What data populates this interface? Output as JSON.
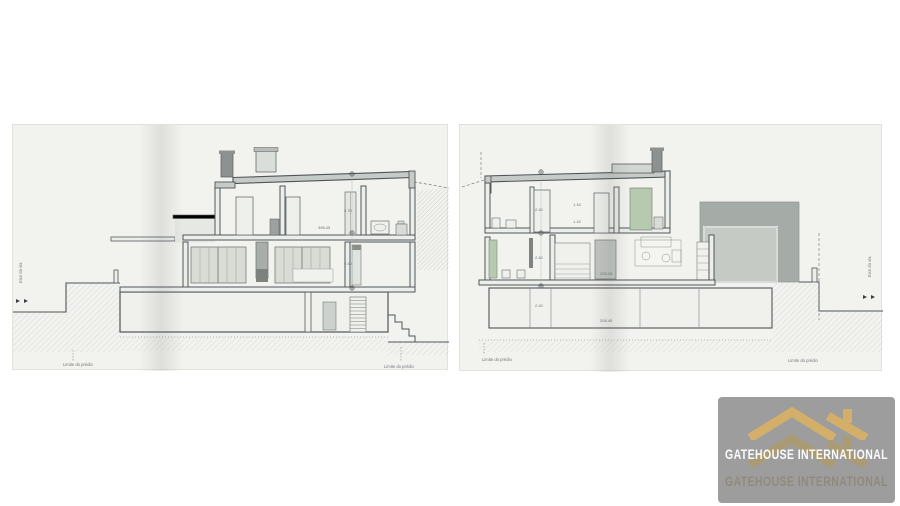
{
  "watermark": {
    "brand": "GATEHOUSE INTERNATIONAL",
    "brand_shadow": "GATEHOUSE INTERNATIONAL",
    "panel_color": "#9d9d9d",
    "gold": "#d4af6a",
    "gold_shadow": "#b89a55",
    "text_color": "#fbfbfb"
  },
  "sheets": {
    "left": {
      "axis_label": "Eixo da via",
      "limit_label_left": "Limite do prédio",
      "limit_label_right": "Limite do prédio",
      "dims": {
        "upper_height": "2.70",
        "mid_height": "2.40",
        "level_note": "498.45"
      }
    },
    "right": {
      "axis_label": "Eixo da via",
      "limit_label_left": "Limite do prédio",
      "limit_label_right": "Limite do prédio",
      "dims": {
        "upper_height": "2.40",
        "note_a": "1.16",
        "note_b": "1.16",
        "mid_height": "2.40",
        "level_note_mid": "203.08",
        "basement_height": "2.40",
        "level_note_base": "208.45"
      }
    }
  },
  "drawing_colors": {
    "paper": "#f2f2ef",
    "ink": "#565b5e",
    "roof_fill": "#c7cbc7",
    "chimney_fill": "#8d918f",
    "glazing_fill": "#d8dcd5",
    "green_fill": "#b6cab0",
    "massing_dark": "#a5aba7",
    "massing_light": "#c5cac5"
  }
}
